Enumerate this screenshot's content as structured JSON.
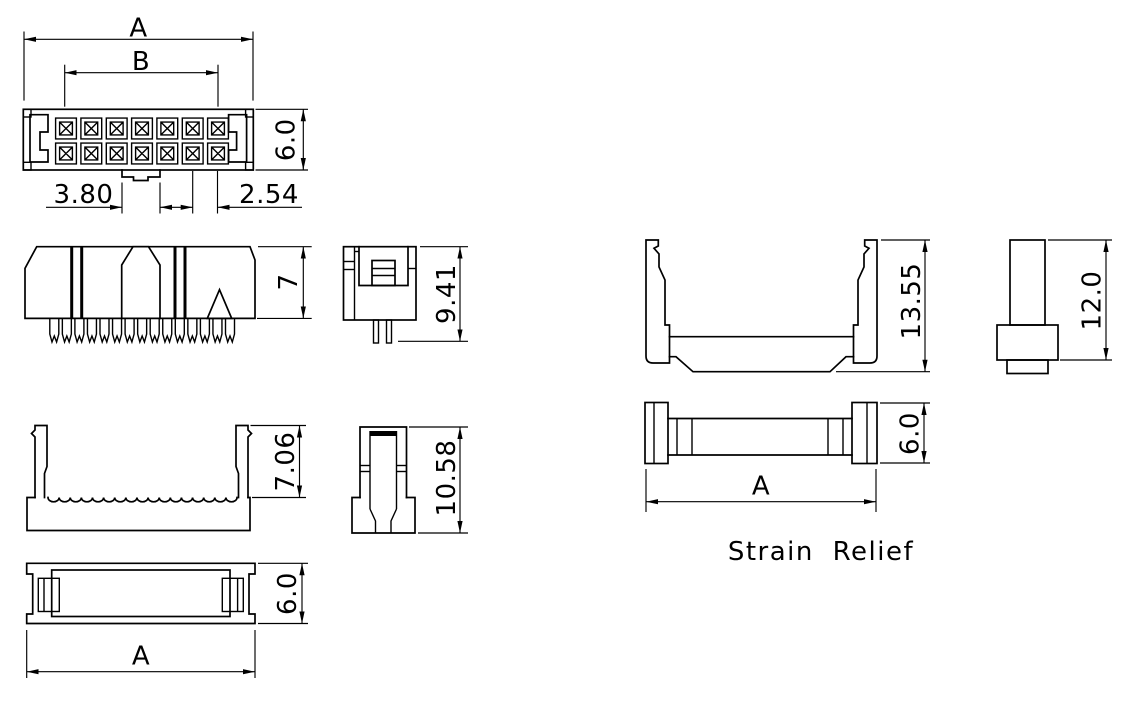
{
  "colors": {
    "line": "#000000",
    "background": "#ffffff"
  },
  "labels": {
    "strain_relief": "Strain Relief"
  },
  "dims": {
    "top": {
      "width": "A",
      "contact_span": "B",
      "height": "6.0",
      "key_width": "3.80",
      "pitch": "2.54"
    },
    "front": {
      "height": "7"
    },
    "side": {
      "height": "9.41"
    },
    "cover_front": {
      "height": "7.06"
    },
    "cover_side": {
      "height": "10.58"
    },
    "bottom": {
      "height": "6.0",
      "width": "A"
    },
    "sr_front": {
      "height": "13.55"
    },
    "sr_side": {
      "height": "12.0"
    },
    "sr_top": {
      "height": "6.0",
      "width": "A"
    }
  }
}
